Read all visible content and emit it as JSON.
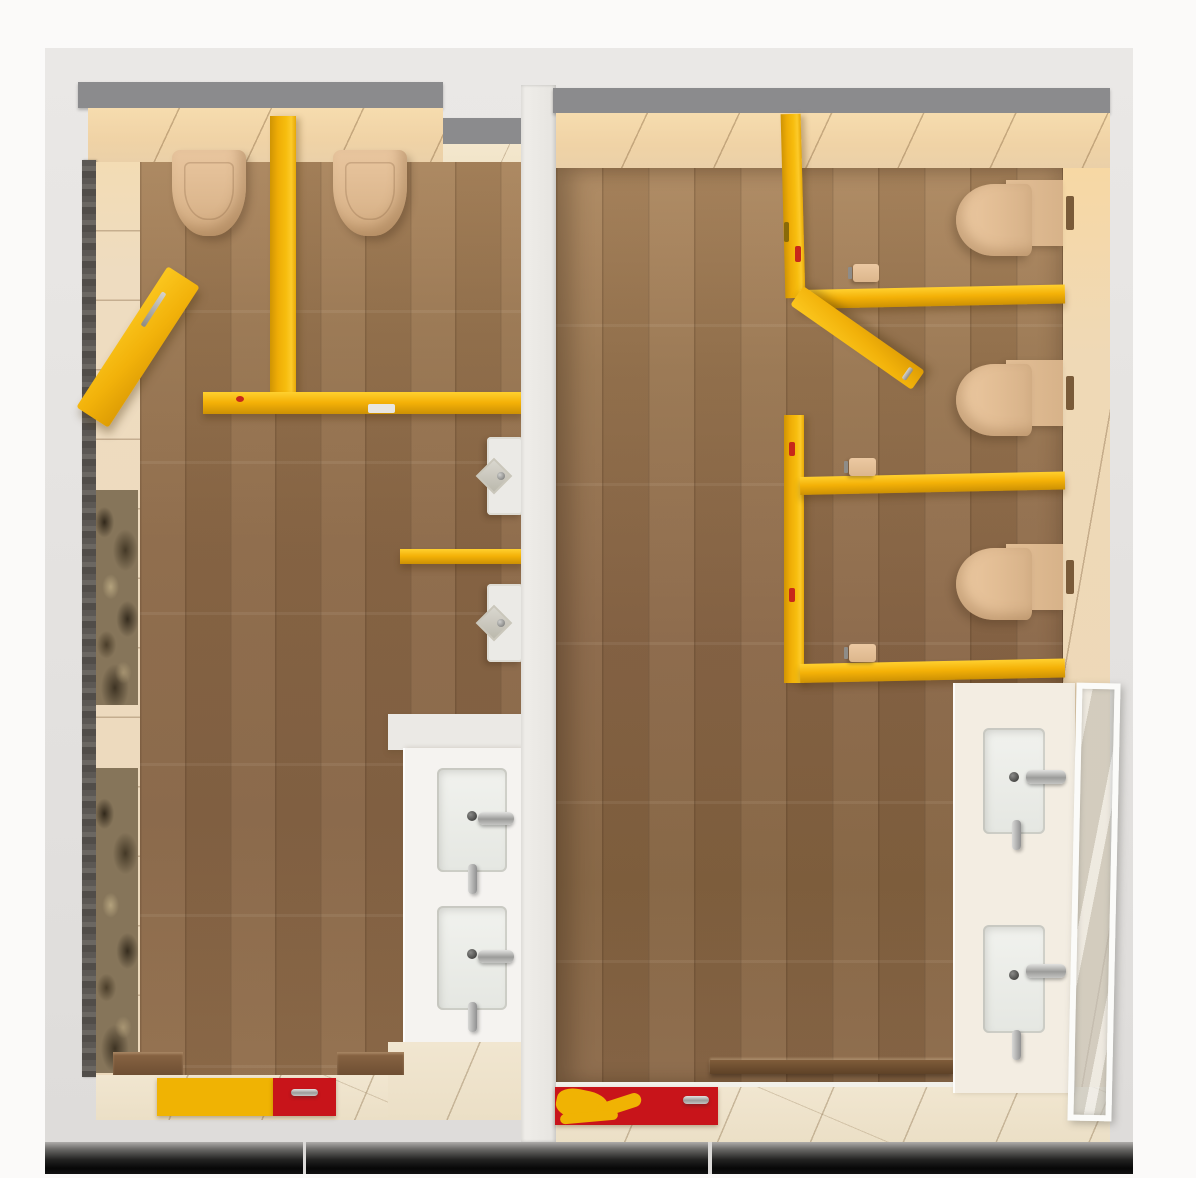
{
  "scene": {
    "type": "3d_rendered_top_down_floor_plan",
    "subject": "Bird's-eye architectural render of two adjacent public restrooms with wood floors, beige tiled walls and yellow toilet-stall partitions",
    "rooms": [
      {
        "id": "left-restroom",
        "wall_hung_toilets": 2,
        "urinals": 2,
        "urinal_privacy_shelf": 1,
        "sink_basins": 2,
        "open_swing_door": 1,
        "stall_partition_color": "yellow",
        "wall_art": "sepia photo mural panels on left wall",
        "entry_mat_colors": [
          "yellow",
          "red"
        ]
      },
      {
        "id": "right-restroom",
        "wall_hung_toilets": 3,
        "toilet_stalls": 3,
        "toilet_paper_holders": 3,
        "sink_basins": 2,
        "open_swing_door": 1,
        "glass_door": 1,
        "wood_bench": 1,
        "stall_partition_color": "yellow",
        "entry_mat_colors": [
          "red",
          "yellow"
        ]
      }
    ],
    "materials": {
      "floor": "wood plank",
      "floor_border": "beige ceramic tile",
      "walls": "beige large-format tile",
      "partitions": "yellow painted panels",
      "counters": "white / cream solid surface",
      "fittings": "chrome"
    }
  },
  "palette": {
    "background_white": "#fbfaf9",
    "shell_gray": "#e6e4e2",
    "wall_cap_gray": "#8b8b8d",
    "divider_white": "#ebe9e6",
    "tile_beige": "#ecd9bc",
    "tile_warm_glow": "#f6dcae",
    "floor_tile_beige": "#efe5cf",
    "wood_light": "#a9845c",
    "wood_mid": "#8a6746",
    "wood_dark": "#6e4f33",
    "partition_yellow": "#f4b107",
    "partition_yellow_light": "#ffd02f",
    "partition_yellow_dark": "#cd9104",
    "fixture_beige": "#e2bd94",
    "porcelain_white": "#ebeae6",
    "counter_white": "#f5f3f0",
    "counter_cream": "#f3ede2",
    "chrome_gray": "#9c9c9a",
    "latch_white": "#e8e6e1",
    "mat_yellow": "#f0b303",
    "mat_red": "#c8141a",
    "photo_sepia": "#86755a",
    "glass_frame": "#fbfbf9",
    "shadow_black": "#0a0a0a"
  }
}
